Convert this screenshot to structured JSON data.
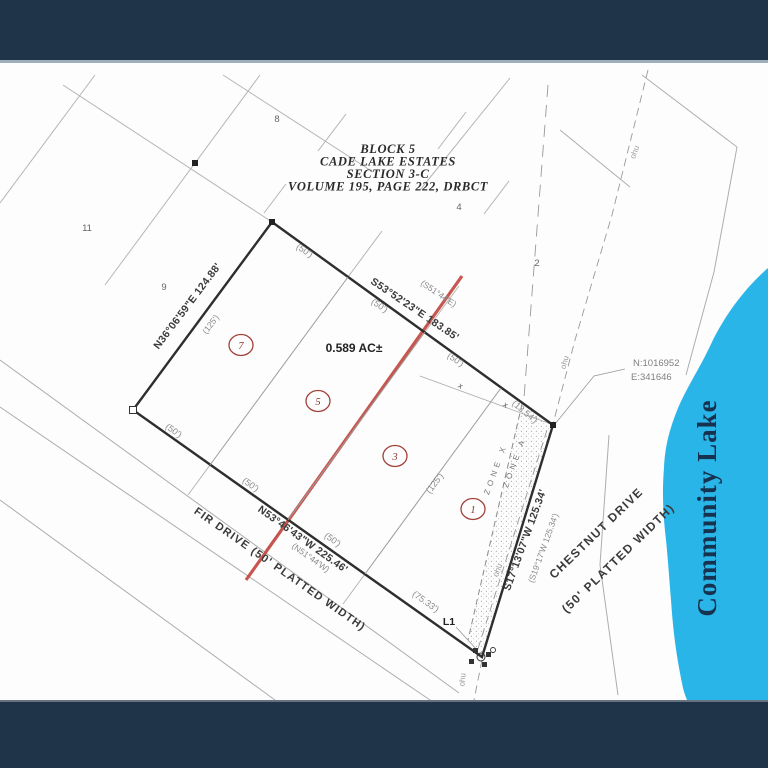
{
  "title_block": {
    "line1": "BLOCK 5",
    "line2": "CADE LAKE ESTATES",
    "line3": "SECTION 3-C",
    "line4": "VOLUME 195, PAGE 222, DRBCT"
  },
  "area_label": "0.589 AC±",
  "bearings": {
    "north": "S53°52'23\"E  183.85'",
    "north_record": "(S51°44'E)",
    "west": "N36°06'59\"E  124.88'",
    "west_record": "(125')",
    "south": "N53°46'43\"W  225.46'",
    "south_record": "(N51°44'W)",
    "east": "S17°13'07\"W  125.34'",
    "east_record": "(S19°17'W 125.34')"
  },
  "ticks": {
    "d50": "(50')",
    "d125": "(125')",
    "d7533": "(75.33')",
    "d1354": "(13.54')"
  },
  "roads": {
    "fir": "FIR DRIVE (50' PLATTED WIDTH)",
    "chestnut_1": "CHESTNUT DRIVE",
    "chestnut_2": "(50' PLATTED WIDTH)"
  },
  "lots": {
    "c7": "7",
    "c5": "5",
    "c3": "3",
    "c1": "1"
  },
  "adjacent_lots": {
    "n8": "8",
    "n11": "11",
    "n9": "9",
    "n4": "4",
    "n2": "2"
  },
  "zones": {
    "zone_x": "ZONE X",
    "zone_a": "ZONE A"
  },
  "reference": {
    "northing": "N:1016952",
    "easting": "E:341646",
    "l1": "L1",
    "ohu": "ohu",
    "xmark": "x"
  },
  "lake": {
    "name": "Community Lake",
    "fill": "#2ab5e9",
    "text_color": "#16324f"
  },
  "colors": {
    "banner": "#203449",
    "red_line": "#c2453c",
    "boundary": "#2e2e2e"
  }
}
